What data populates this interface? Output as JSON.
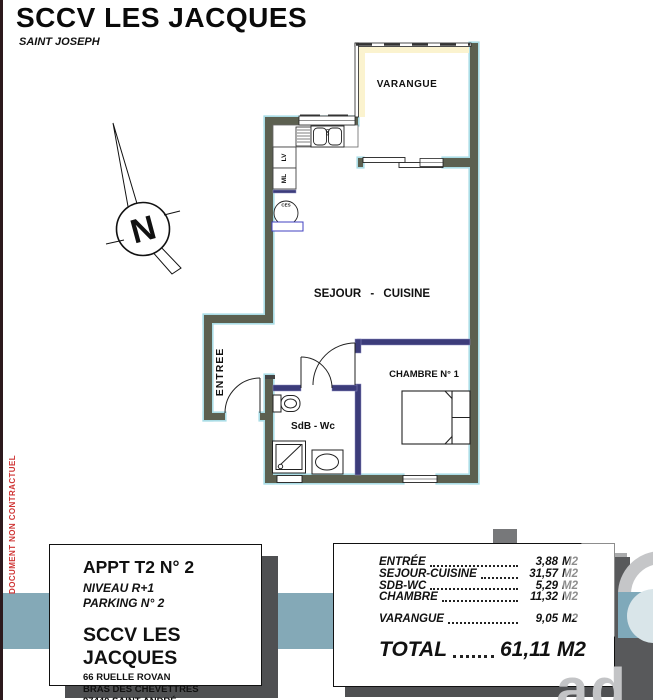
{
  "header": {
    "title": "SCCV LES JACQUES",
    "subtitle": "SAINT JOSEPH"
  },
  "side_note": "DOCUMENT NON CONTRACTUEL",
  "compass": {
    "letter": "N"
  },
  "plan": {
    "labels": {
      "varangue": "VARANGUE",
      "sejour": "SEJOUR - CUISINE",
      "entree": "ENTREE",
      "chambre": "CHAMBRE N° 1",
      "sdb": "SdB - Wc"
    },
    "appliances": {
      "lv": "LV",
      "ml": "ML",
      "ce": "CES"
    }
  },
  "info_box": {
    "apt": "APPT T2 N° 2",
    "level": "NIVEAU R+1",
    "parking": "PARKING N° 2",
    "company": "SCCV LES JACQUES",
    "address1": "66 RUELLE ROVAN",
    "address2": "BRAS DES CHEVETTRES",
    "address3": "97440 SAINT ANDRÉ"
  },
  "areas": {
    "rows": [
      {
        "label": "ENTRÉE",
        "value": "3,88",
        "unit": "M2"
      },
      {
        "label": "SEJOUR-CUISINE",
        "value": "31,57",
        "unit": "M2"
      },
      {
        "label": "SDB-WC",
        "value": "5,29",
        "unit": "M2"
      },
      {
        "label": "CHAMBRE",
        "value": "11,32",
        "unit": "M2"
      },
      {
        "label": "VARANGUE",
        "value": "9,05",
        "unit": "M2"
      }
    ],
    "total": {
      "label": "TOTAL",
      "value": "61,11",
      "unit": "M2"
    }
  },
  "watermark": {
    "letters": ".ad"
  },
  "colors": {
    "band": "#84a9b7",
    "exterior_wall": "#5c6050",
    "wall_outline": "#aadde6",
    "partition": "#3c3c7a",
    "note_red": "#cf3434",
    "pale_yellow": "#fbf3cf",
    "shadow": "#4f5052",
    "watermark_gray": "#58595b",
    "watermark_blue": "#7fa9ba"
  }
}
